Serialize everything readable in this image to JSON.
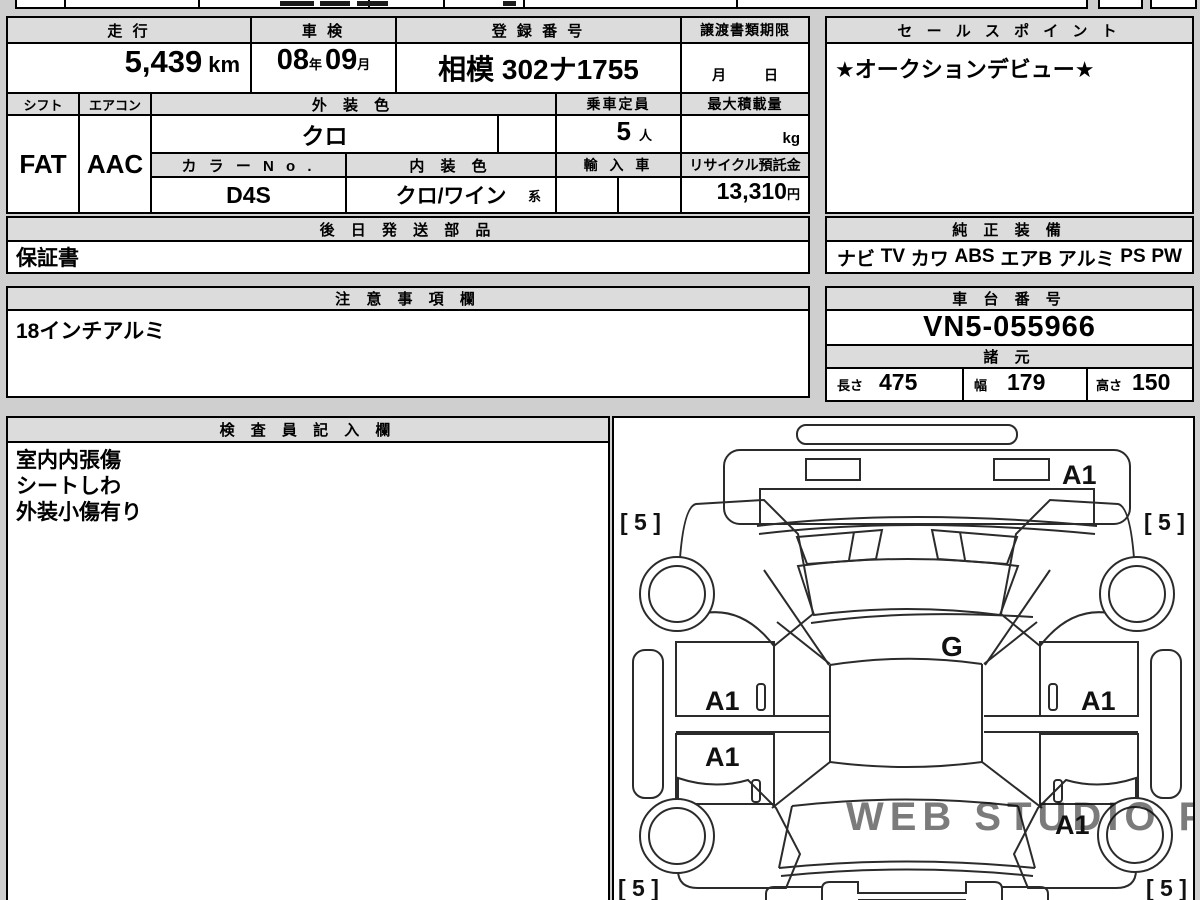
{
  "page": {
    "background": "#cfcfcf"
  },
  "table": {
    "mileage": {
      "label": "走 行",
      "value": "5,439",
      "unit": "km"
    },
    "inspection": {
      "label": "車 検",
      "year": "08",
      "year_suffix": "年",
      "month": "09",
      "month_suffix": "月"
    },
    "registration": {
      "label": "登 録 番 号",
      "value": "相模 302ナ1755"
    },
    "transfer_docs_deadline": {
      "label": "譲渡書類期限",
      "month_label": "月",
      "day_label": "日"
    },
    "shift": {
      "label": "シフト",
      "value": "FAT"
    },
    "aircon": {
      "label": "エアコン",
      "value": "AAC"
    },
    "exterior_color": {
      "label": "外 装 色",
      "value": "クロ"
    },
    "capacity": {
      "label": "乗車定員",
      "value": "5",
      "unit": "人"
    },
    "max_load": {
      "label": "最大積載量",
      "unit": "kg"
    },
    "color_no": {
      "label": "カ ラ ー N o .",
      "value": "D4S"
    },
    "interior_color": {
      "label": "内 装 色",
      "value": "クロ/ワイン",
      "suffix": "系"
    },
    "imported": {
      "label": "輸 入 車"
    },
    "recycle_deposit": {
      "label": "リサイクル預託金",
      "value": "13,310",
      "unit": "円"
    }
  },
  "sales_point": {
    "label": "セ ー ル ス ポ イ ン ト",
    "value": "★オークションデビュー★"
  },
  "later_shipped_parts": {
    "label": "後 日 発 送 部 品",
    "value": "保証書"
  },
  "genuine_equipment": {
    "label": "純 正 装 備",
    "items": [
      "ナビ",
      "TV",
      "カワ",
      "ABS",
      "エアB",
      "アルミ",
      "PS",
      "PW"
    ]
  },
  "cautions": {
    "label": "注 意 事 項 欄",
    "value": "18インチアルミ"
  },
  "chassis_number": {
    "label": "車 台 番 号",
    "value": "VN5-055966"
  },
  "dimensions": {
    "label": "諸 元",
    "length_label": "長さ",
    "length": "475",
    "width_label": "幅",
    "width": "179",
    "height_label": "高さ",
    "height": "150"
  },
  "inspector_notes": {
    "label": "検 査 員 記 入 欄",
    "lines": [
      "室内内張傷",
      "シートしわ",
      "外装小傷有り"
    ]
  },
  "diagram": {
    "glass_mark": "G",
    "front_bumper_mark": "A1",
    "left_front_door_mark": "A1",
    "left_rear_door_mark": "A1",
    "right_front_door_mark": "A1",
    "right_rear_quarter_mark": "A1",
    "wheel_mark": "[ 5 ]",
    "watermark": "WEB STUDIO PRO"
  }
}
